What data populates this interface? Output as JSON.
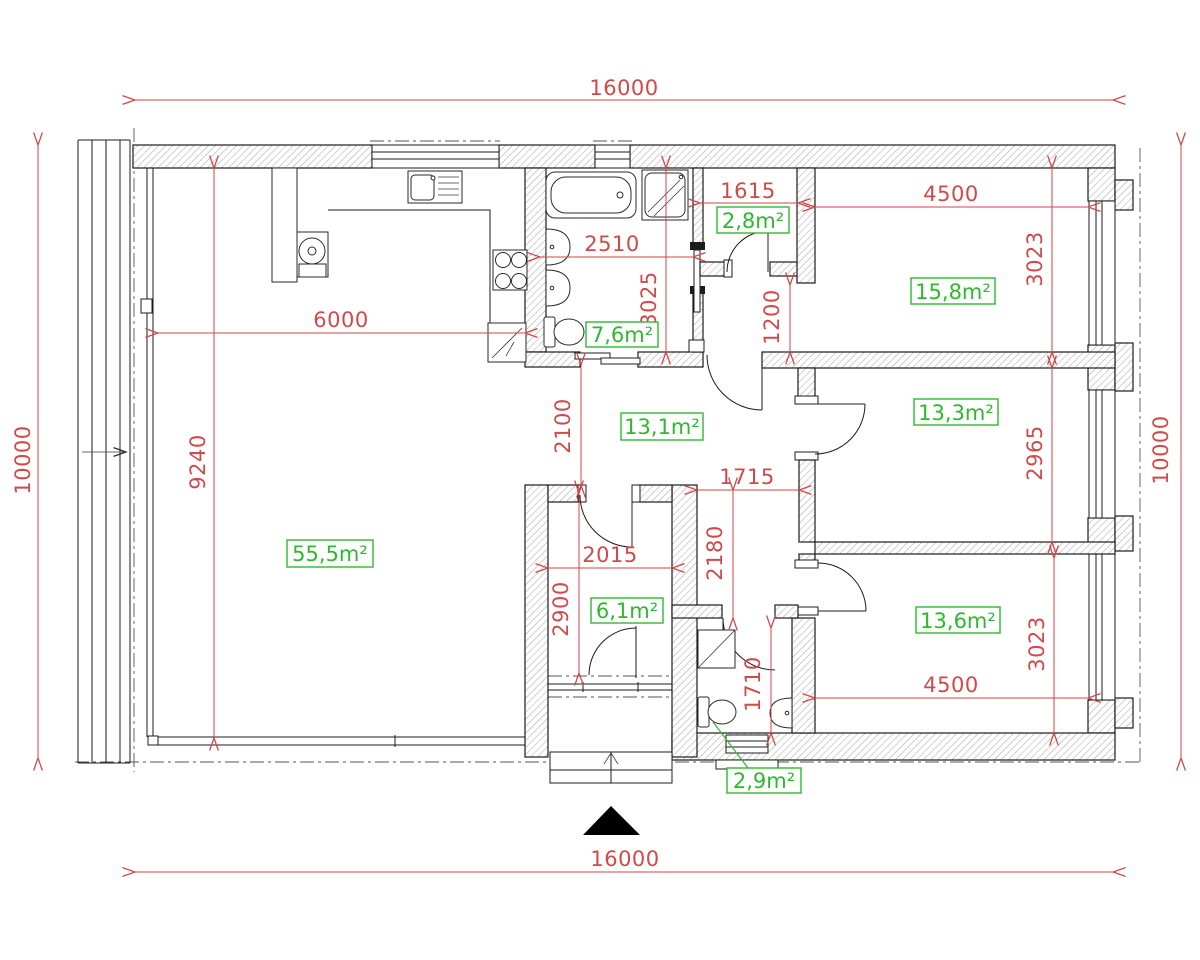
{
  "drawing": {
    "type": "apartment floor plan",
    "overall": {
      "top": "16000",
      "bottom": "16000",
      "left": "10000",
      "right": "10000"
    },
    "dims": {
      "living_width": "6000",
      "living_height": "9240",
      "bath_width": "2510",
      "bath_height": "3025",
      "closet_width": "1615",
      "vestibule_height": "1200",
      "bed1_width": "4500",
      "bed1_height": "3023",
      "bed2_height": "2965",
      "hall_height": "2100",
      "corridor_width": "1715",
      "corridor_height": "2180",
      "entry_width": "2015",
      "entry_height": "2900",
      "wc_height": "1710",
      "bed3_width": "4500",
      "bed3_height": "3023"
    },
    "areas": {
      "living": "55,5m²",
      "bath": "7,6m²",
      "closet": "2,8m²",
      "bed1": "15,8m²",
      "hall": "13,1m²",
      "bed2": "13,3m²",
      "entry": "6,1m²",
      "wc": "2,9m²",
      "bed3": "13,6m²"
    },
    "colors": {
      "dimension": "#d04545",
      "area": "#2fb82f"
    }
  }
}
